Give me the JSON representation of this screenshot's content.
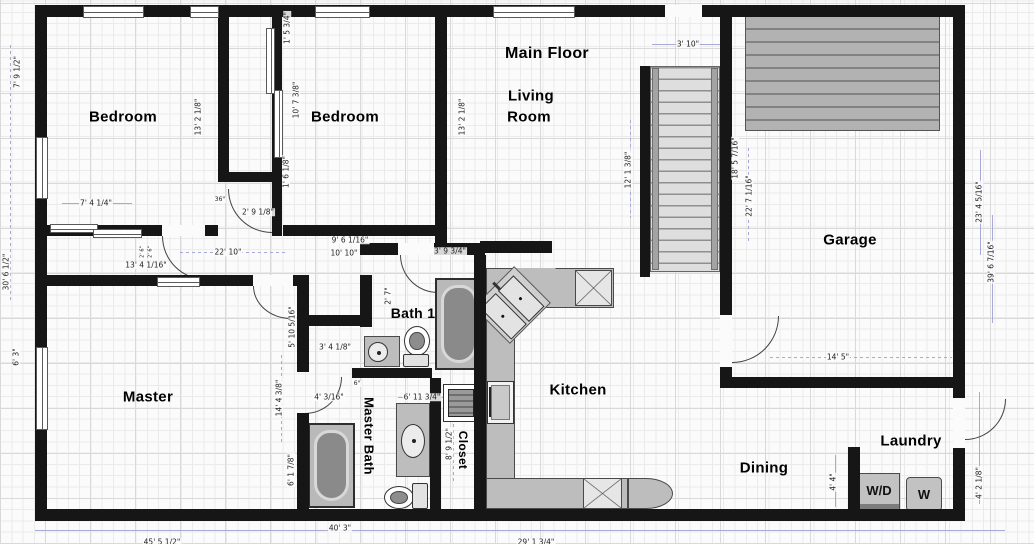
{
  "title": "Main Floor",
  "colors": {
    "wall": "#161616",
    "counter": "#bdbdbd",
    "fixture": "#8a8a8a",
    "deck": "#b2b2b2",
    "guide_line": "#a9a9d6",
    "dimension_text": "#1d1d1d",
    "label_text": "#000000"
  },
  "laundry": {
    "washer_dryer_label": "W/D",
    "washer_label": "W"
  },
  "rooms": [
    {
      "id": "main-floor-title",
      "label": "Main Floor",
      "x": 547,
      "y": 54,
      "size": 16,
      "rot": 0
    },
    {
      "id": "living-room-line1",
      "label": "Living",
      "x": 531,
      "y": 96,
      "size": 15,
      "rot": 0
    },
    {
      "id": "living-room-line2",
      "label": "Room",
      "x": 529,
      "y": 117,
      "size": 15,
      "rot": 0
    },
    {
      "id": "bedroom-1",
      "label": "Bedroom",
      "x": 123,
      "y": 117,
      "size": 15,
      "rot": 0
    },
    {
      "id": "bedroom-2",
      "label": "Bedroom",
      "x": 345,
      "y": 117,
      "size": 15,
      "rot": 0
    },
    {
      "id": "garage",
      "label": "Garage",
      "x": 850,
      "y": 240,
      "size": 15,
      "rot": 0
    },
    {
      "id": "master",
      "label": "Master",
      "x": 148,
      "y": 397,
      "size": 15,
      "rot": 0
    },
    {
      "id": "bath-1",
      "label": "Bath 1",
      "x": 413,
      "y": 313,
      "size": 14,
      "rot": 0
    },
    {
      "id": "master-bath",
      "label": "Master Bath",
      "x": 369,
      "y": 436,
      "size": 13,
      "rot": 90
    },
    {
      "id": "closet",
      "label": "Closet",
      "x": 463,
      "y": 450,
      "size": 12,
      "rot": 90
    },
    {
      "id": "kitchen",
      "label": "Kitchen",
      "x": 578,
      "y": 390,
      "size": 15,
      "rot": 0
    },
    {
      "id": "dining",
      "label": "Dining",
      "x": 764,
      "y": 468,
      "size": 15,
      "rot": 0
    },
    {
      "id": "laundry",
      "label": "Laundry",
      "x": 911,
      "y": 441,
      "size": 15,
      "rot": 0
    }
  ],
  "dimensions": [
    {
      "text": "7' 9 1/2\"",
      "x": 17,
      "y": 72,
      "rot": 90
    },
    {
      "text": "30' 6 1/2\"",
      "x": 6,
      "y": 272,
      "rot": 90
    },
    {
      "text": "6' 3\"",
      "x": 16,
      "y": 357,
      "rot": 90
    },
    {
      "text": "13' 2 1/8\"",
      "x": 198,
      "y": 117,
      "rot": 90
    },
    {
      "text": "1' 5 3/4\"",
      "x": 287,
      "y": 28,
      "rot": 90
    },
    {
      "text": "10' 7 3/8\"",
      "x": 296,
      "y": 100,
      "rot": 90
    },
    {
      "text": "1' 6 1/8\"",
      "x": 286,
      "y": 172,
      "rot": 90
    },
    {
      "text": "13' 2 1/8\"",
      "x": 462,
      "y": 117,
      "rot": 90
    },
    {
      "text": "12' 1 3/8\"",
      "x": 628,
      "y": 170,
      "rot": 90
    },
    {
      "text": "3' 10\"",
      "x": 688,
      "y": 44,
      "rot": 0
    },
    {
      "text": "18' 5 7/16\"",
      "x": 735,
      "y": 158,
      "rot": 90
    },
    {
      "text": "22' 7 1/16\"",
      "x": 749,
      "y": 196,
      "rot": 90
    },
    {
      "text": "23' 4 5/16\"",
      "x": 979,
      "y": 202,
      "rot": 90
    },
    {
      "text": "39' 6 7/16\"",
      "x": 991,
      "y": 262,
      "rot": 90
    },
    {
      "text": "7' 4 1/4\"",
      "x": 96,
      "y": 203,
      "rot": 0
    },
    {
      "text": "36\"",
      "x": 220,
      "y": 200,
      "rot": 0,
      "s": 6
    },
    {
      "text": "2' 9 1/8\"",
      "x": 258,
      "y": 212,
      "rot": 0
    },
    {
      "text": "22' 10\"",
      "x": 228,
      "y": 252,
      "rot": 0
    },
    {
      "text": "13' 4 1/16\"",
      "x": 146,
      "y": 265,
      "rot": 0
    },
    {
      "text": "9' 6 1/16\"",
      "x": 350,
      "y": 240,
      "rot": 0
    },
    {
      "text": "10' 10\"",
      "x": 344,
      "y": 253,
      "rot": 0
    },
    {
      "text": "3' 9 3/4\"",
      "x": 450,
      "y": 251,
      "rot": 0
    },
    {
      "text": "2' 7\"",
      "x": 388,
      "y": 296,
      "rot": 90
    },
    {
      "text": "5' 10 5/16\"",
      "x": 292,
      "y": 327,
      "rot": 90
    },
    {
      "text": "3' 4 1/8\"",
      "x": 335,
      "y": 347,
      "rot": 0
    },
    {
      "text": "4' 3/16\"",
      "x": 329,
      "y": 397,
      "rot": 0
    },
    {
      "text": "6\"",
      "x": 357,
      "y": 384,
      "rot": 0,
      "s": 6
    },
    {
      "text": "14' 4 3/8\"",
      "x": 279,
      "y": 398,
      "rot": 90
    },
    {
      "text": "6' 1 7/8\"",
      "x": 291,
      "y": 470,
      "rot": 90
    },
    {
      "text": "6' 11 3/4\"",
      "x": 422,
      "y": 397,
      "rot": 0
    },
    {
      "text": "8' 9 1/2\"",
      "x": 449,
      "y": 444,
      "rot": 90
    },
    {
      "text": "2' 6\"",
      "x": 143,
      "y": 252,
      "rot": 90,
      "s": 5
    },
    {
      "text": "2' 6\"",
      "x": 151,
      "y": 252,
      "rot": 90,
      "s": 5
    },
    {
      "text": "14' 5\"",
      "x": 838,
      "y": 357,
      "rot": 0
    },
    {
      "text": "4' 4\"",
      "x": 833,
      "y": 482,
      "rot": 90
    },
    {
      "text": "4' 2 1/8\"",
      "x": 979,
      "y": 483,
      "rot": 90
    },
    {
      "text": "40' 3\"",
      "x": 340,
      "y": 528,
      "rot": 0
    },
    {
      "text": "45' 5 1/2\"",
      "x": 162,
      "y": 542,
      "rot": 0
    },
    {
      "text": "29' 1 3/4\"",
      "x": 536,
      "y": 542,
      "rot": 0
    }
  ]
}
